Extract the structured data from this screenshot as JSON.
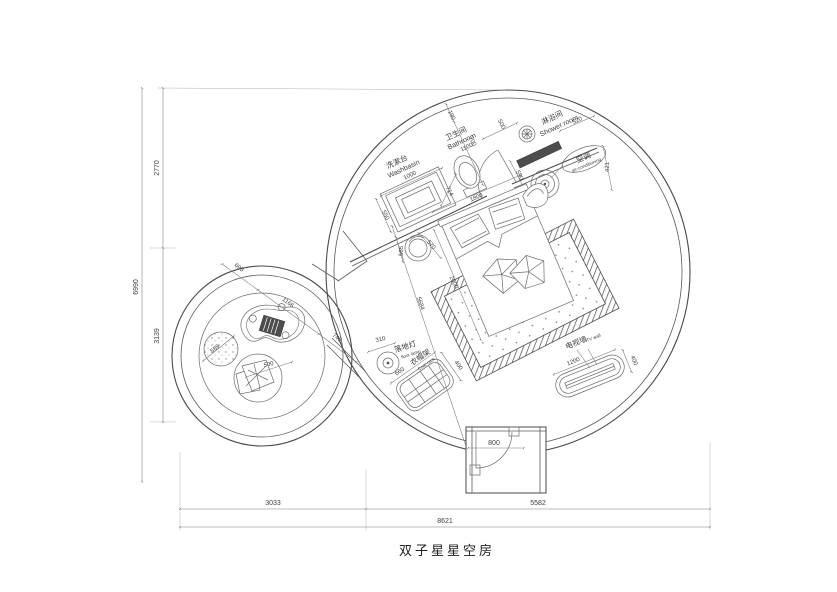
{
  "title": "双子星星空房",
  "labels": {
    "washbasin": {
      "cn": "洗漱台",
      "en": "Washbasin",
      "dim": "1000"
    },
    "bathroom": {
      "cn": "卫生间",
      "en": "Bathroom",
      "dim": "1100"
    },
    "shower": {
      "cn": "淋浴间",
      "en": "Shower room"
    },
    "ac": {
      "cn": "空调",
      "en": "air-conditioning"
    },
    "floor_lamp": {
      "cn": "落地灯",
      "en": "floor lamp",
      "dim": "310"
    },
    "coat_rack": {
      "cn": "衣帽架",
      "en": "Coat rack",
      "dim_l": "660",
      "dim_w": "400"
    },
    "tv_wall": {
      "cn": "电视墙",
      "en": "TV wall",
      "dim_l": "1200",
      "dim_w": "400"
    },
    "entry": {
      "dim": "800"
    }
  },
  "dims": {
    "d190": "190",
    "d700": "700",
    "d500": "500",
    "d590": "590",
    "d520": "520",
    "d421": "421",
    "d714": "714",
    "d550": "550",
    "bed_w": "1800",
    "bed_l": "2000",
    "stool_a": "565",
    "stool_b": "570",
    "diag": "5684",
    "lounge_a": "693",
    "lounge_b": "1166",
    "lounge_c": "745",
    "pouf": "589",
    "chair": "500",
    "margin_left_total": "6990",
    "margin_left_top": "2770",
    "margin_left_bottom": "3139",
    "margin_bottom_left": "3033",
    "margin_bottom_right": "5582",
    "margin_bottom_total": "8621"
  }
}
